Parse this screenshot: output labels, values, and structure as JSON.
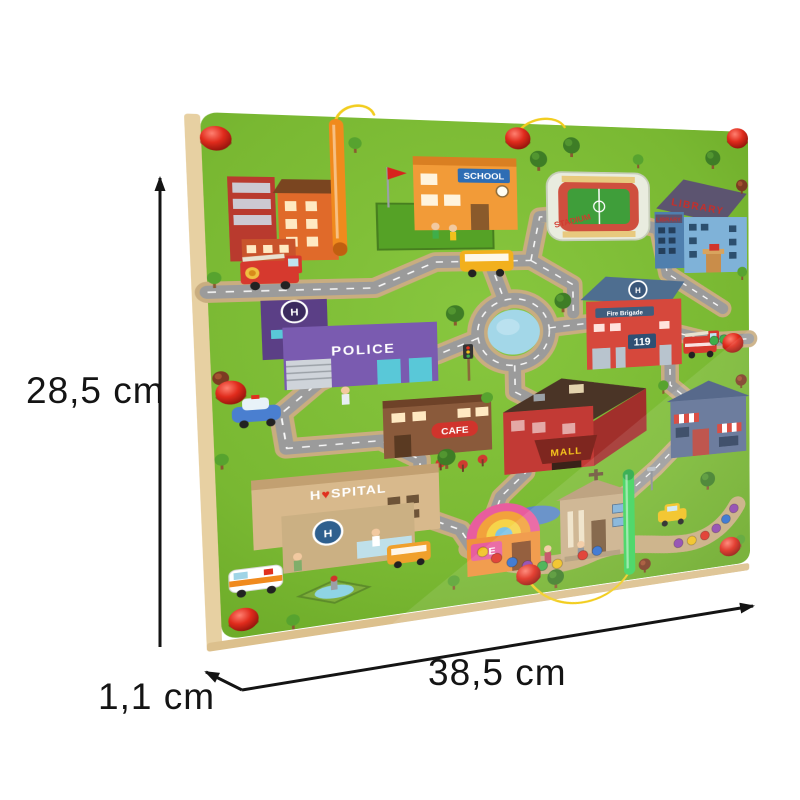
{
  "page": {
    "background": "#ffffff"
  },
  "annotations": {
    "height_label": "28,5 cm",
    "width_label": "38,5 cm",
    "thickness_label": "1,1 cm"
  },
  "board": {
    "labels": {
      "school": "SCHOOL",
      "stadium": "STADIUM",
      "library_roof": "LIBRARY",
      "library_side": "LIBRARY",
      "police": "POLICE",
      "fire_brigade": "Fire Brigade",
      "fire_number": "119",
      "cafe": "CAFE",
      "mall": "MALL",
      "hospital_prefix": "H",
      "hospital_heart": "♥",
      "hospital_suffix": "SPITAL",
      "ice_cream": "ICE",
      "helipad": "H"
    },
    "colors": {
      "surface": "#7ab832",
      "wood_edge": "#e7d0a2",
      "road": "#9b9b9b",
      "groove": "#c9ad80",
      "pond": "#a3d7e8",
      "knob": "#dd2b1e",
      "pen_orange": "#f08a1d",
      "pen_green": "#3ed45c",
      "string": "#f2cd1f"
    },
    "marble_colors": [
      "#f2c11d",
      "#df3125",
      "#2f6fd0",
      "#8e44ad",
      "#3fae4a"
    ]
  }
}
